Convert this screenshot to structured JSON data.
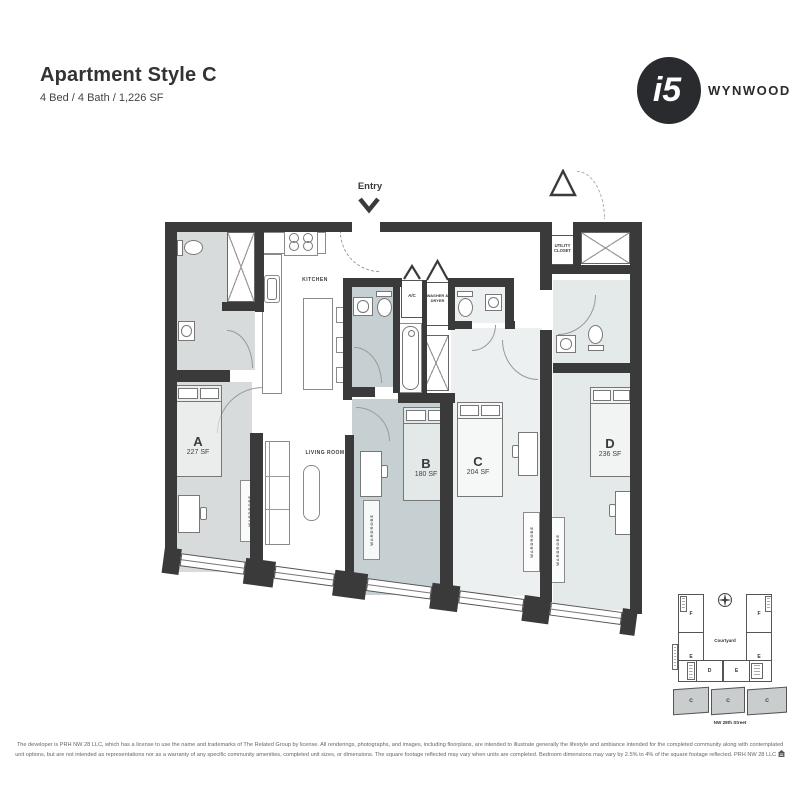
{
  "header": {
    "title": "Apartment Style C",
    "subtitle": "4 Bed / 4 Bath / 1,226 SF"
  },
  "logo": {
    "mark": "i5",
    "brand": "WYNWOOD"
  },
  "plan": {
    "entry": "Entry",
    "kitchen": "KITCHEN",
    "living_room": "LIVING ROOM",
    "ac": "A/C",
    "washer_dryer": "WASHER & DRYER",
    "utility_closet": "UTILITY CLOSET",
    "wardrobe": "WARDROBE",
    "rooms": {
      "a": {
        "letter": "A",
        "area": "227 SF"
      },
      "b": {
        "letter": "B",
        "area": "180 SF"
      },
      "c": {
        "letter": "C",
        "area": "204 SF"
      },
      "d": {
        "letter": "D",
        "area": "236 SF"
      }
    }
  },
  "keyplan": {
    "courtyard_label": "Courtyard",
    "street_label": "NW 28th Street",
    "units": {
      "f_left": "F",
      "f_right": "F",
      "e_left": "E",
      "e_right": "E",
      "d_bottom": "D",
      "e_bottom": "E",
      "c_1": "C",
      "c_2": "C",
      "c_3": "C"
    }
  },
  "disclaimer": {
    "line1": "The developer is PRH NW 28 LLC, which has a license to use the name and trademarks of The Related Group by license. All renderings, photographs, and images, including floorplans, are intended to illustrate generally the lifestyle and ambiance intended for the completed community along with contemplated",
    "line2": "unit options, but are not intended as representations nor as a warranty of any specific community amenities, completed unit sizes, or dimensions. The square footage reflected may vary when units are completed. Bedroom dimensions may vary by 2.5% to 4% of the square footage reflected. PRH NW 28 LLC"
  },
  "colors": {
    "wall": "#3a3a3a",
    "room_a": "#d7dbdb",
    "room_b": "#c6d0d3",
    "room_c": "#edf0f0",
    "room_d": "#e4e9e9",
    "brand": "#2a2b2e",
    "keyplan_highlight": "#c9cdcd"
  }
}
